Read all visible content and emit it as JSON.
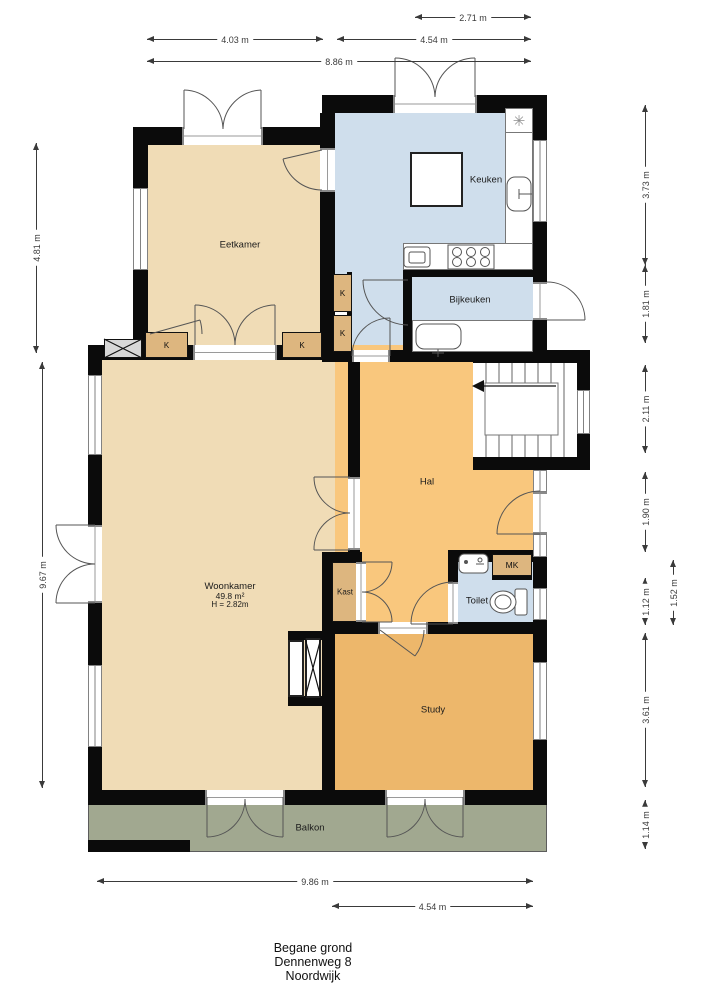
{
  "plan": {
    "title_lines": [
      "Begane grond",
      "Dennenweg 8",
      "Noordwijk"
    ]
  },
  "rooms": {
    "eetkamer": "Eetkamer",
    "keuken": "Keuken",
    "bijkeuken": "Bijkeuken",
    "hal": "Hal",
    "woonkamer_name": "Woonkamer",
    "woonkamer_area": "49.8 m²",
    "woonkamer_height": "H = 2.82m",
    "kast": "Kast",
    "toilet": "Toilet",
    "mk": "MK",
    "study": "Study",
    "balkon": "Balkon",
    "closet": "K"
  },
  "dimensions": {
    "top_271": "2.71 m",
    "top_403": "4.03 m",
    "top_454": "4.54 m",
    "top_886": "8.86 m",
    "left_481": "4.81 m",
    "left_967": "9.67 m",
    "right_373": "3.73 m",
    "right_181": "1.81 m",
    "right_211": "2.11 m",
    "right_190": "1.90 m",
    "right_112": "1.12 m",
    "right_152": "1.52 m",
    "right_361": "3.61 m",
    "right_114": "1.14 m",
    "bottom_986": "9.86 m",
    "bottom_454": "4.54 m"
  },
  "icons": {
    "extractor_fan": "✳"
  },
  "colors": {
    "room_beige": "#f0dcb6",
    "room_blue": "#cfdeec",
    "room_hal": "#f9c77d",
    "room_study": "#edb76b",
    "closet_tan": "#ddb67f",
    "balkon_green": "#a1a890",
    "wall": "#0b0b0b",
    "dim": "#3a3a3a"
  }
}
